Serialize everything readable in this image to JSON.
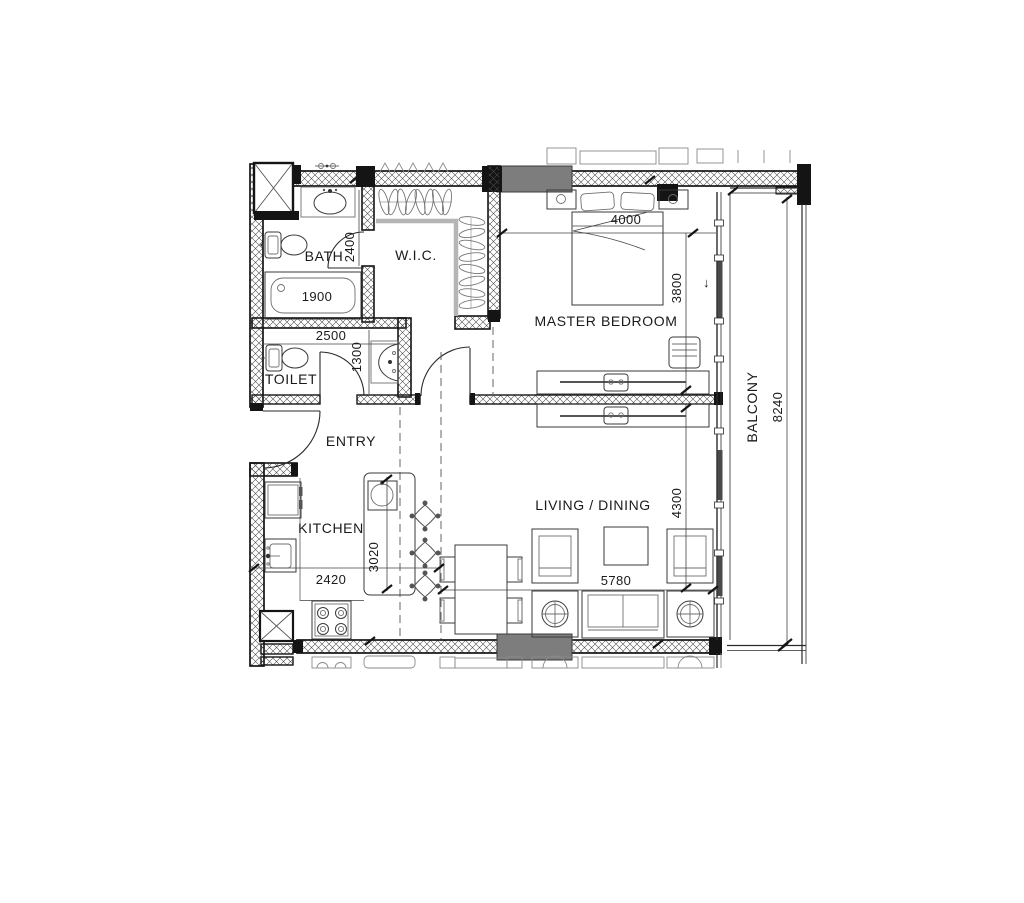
{
  "plan_title": "One-bedroom apartment floor plan",
  "rooms": {
    "bath": "BATH",
    "wic": "W.I.C.",
    "master_bedroom": "MASTER BEDROOM",
    "toilet": "TOILET",
    "entry": "ENTRY",
    "kitchen": "KITCHEN",
    "living_dining": "LIVING / DINING",
    "balcony": "BALCONY"
  },
  "dims": {
    "bath_depth": "2400",
    "tub_length": "1900",
    "toilet_width": "2500",
    "toilet_depth": "1300",
    "bedroom_width": "4000",
    "bedroom_depth": "3800",
    "living_depth": "4300",
    "living_width": "5780",
    "kitchen_width": "2420",
    "kitchen_run": "3020",
    "balcony_length": "8240"
  },
  "icons": {
    "slide_arrow": "↓"
  },
  "colors": {
    "wall_edge": "#141414",
    "wall_hatch": "#4a4a4a",
    "window_block": "#7d7d7d",
    "closet_shelf": "#b5b5b5",
    "background": "#ffffff"
  }
}
